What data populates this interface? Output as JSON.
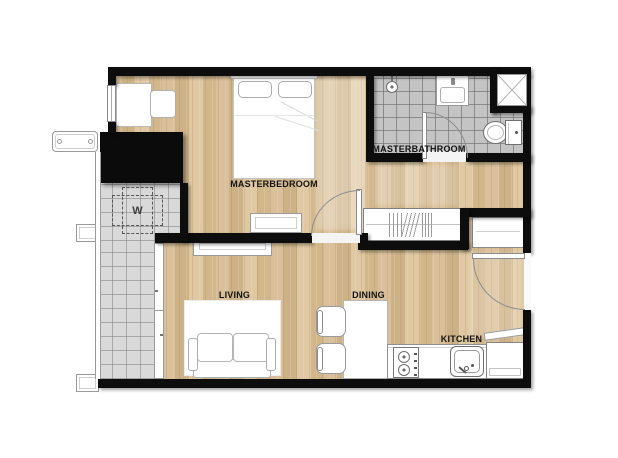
{
  "rooms": {
    "masterbedroom": {
      "label": "MASTERBEDROOM"
    },
    "masterbathroom": {
      "label": "MASTERBATHROOM"
    },
    "living": {
      "label": "LIVING"
    },
    "dining": {
      "label": "DINING"
    },
    "kitchen": {
      "label": "KITCHEN"
    }
  },
  "fixtures": {
    "washer_label": "W",
    "icons": [
      "bed",
      "pillow",
      "wardrobe",
      "washing-machine",
      "toilet",
      "bathroom-vanity",
      "shower-head",
      "sofa",
      "rug",
      "tv-console",
      "dining-table",
      "dining-chair",
      "kitchen-counter",
      "stove",
      "kitchen-sink",
      "refrigerator",
      "shelf",
      "desk",
      "desk-chair",
      "dresser",
      "ac-condenser",
      "planter",
      "service-shaft",
      "window",
      "sliding-door",
      "swing-door",
      "balcony-railing"
    ]
  },
  "colors": {
    "wall": "#0d0d0d",
    "wood": "#d8bd93",
    "tile_bath": "#c4c4c4",
    "tile_balcony": "#d9d9d9",
    "furniture_fill": "#ffffff",
    "furniture_line": "#9a9a9a",
    "label_text": "#141414"
  }
}
